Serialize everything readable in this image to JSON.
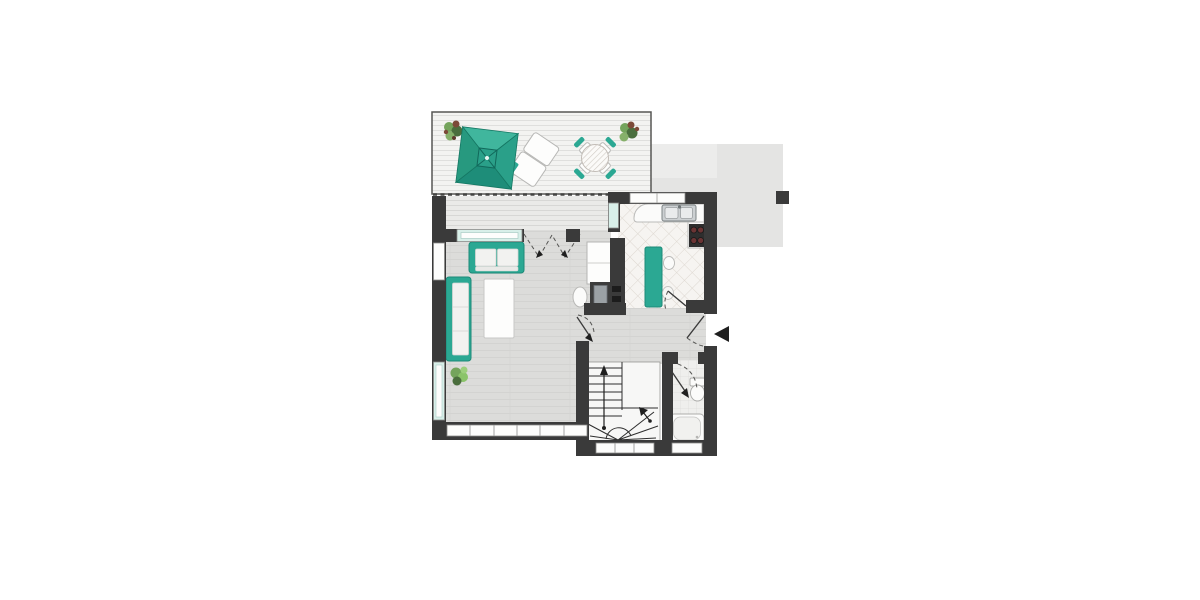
{
  "title": "apartment-floor-plan",
  "colors": {
    "wall": "#3a3a3a",
    "teal": "#2ba893",
    "tealDark": "#1d8a78",
    "tealLight": "#40b69d",
    "tealPale": "#d8efe9",
    "terraceFloor": "#f3f3f1",
    "terraceLine": "#dfdfdd",
    "deckFloor": "#eaeae8",
    "deckLine": "#d7d7d5",
    "woodFloor": "#dcdcda",
    "woodLine": "#d3d3d1",
    "kitchenFloor": "#f6f4f1",
    "kitchenLine": "#ddd7d0",
    "tileFloor": "#efefed",
    "tileLine": "#dedddb",
    "grayBlock": "#e4e4e3",
    "grayBlockLight": "#ececeb",
    "white": "#fdfdfc",
    "outline": "#8c8c8a",
    "plantGreen": "#74a45c",
    "plantDark": "#4a6e3d",
    "plantBerry": "#7c4a38",
    "steel": "#ccd0d2",
    "steelDark": "#7e8486",
    "stove": "#2e2e2e",
    "burner": "#6b3434"
  },
  "plan": {
    "rooms_visible": 6,
    "stair_treads_straight": 7,
    "terrace_dining_chairs": 4,
    "stove_burners": 4,
    "window_panes_bottom_band": 6
  }
}
